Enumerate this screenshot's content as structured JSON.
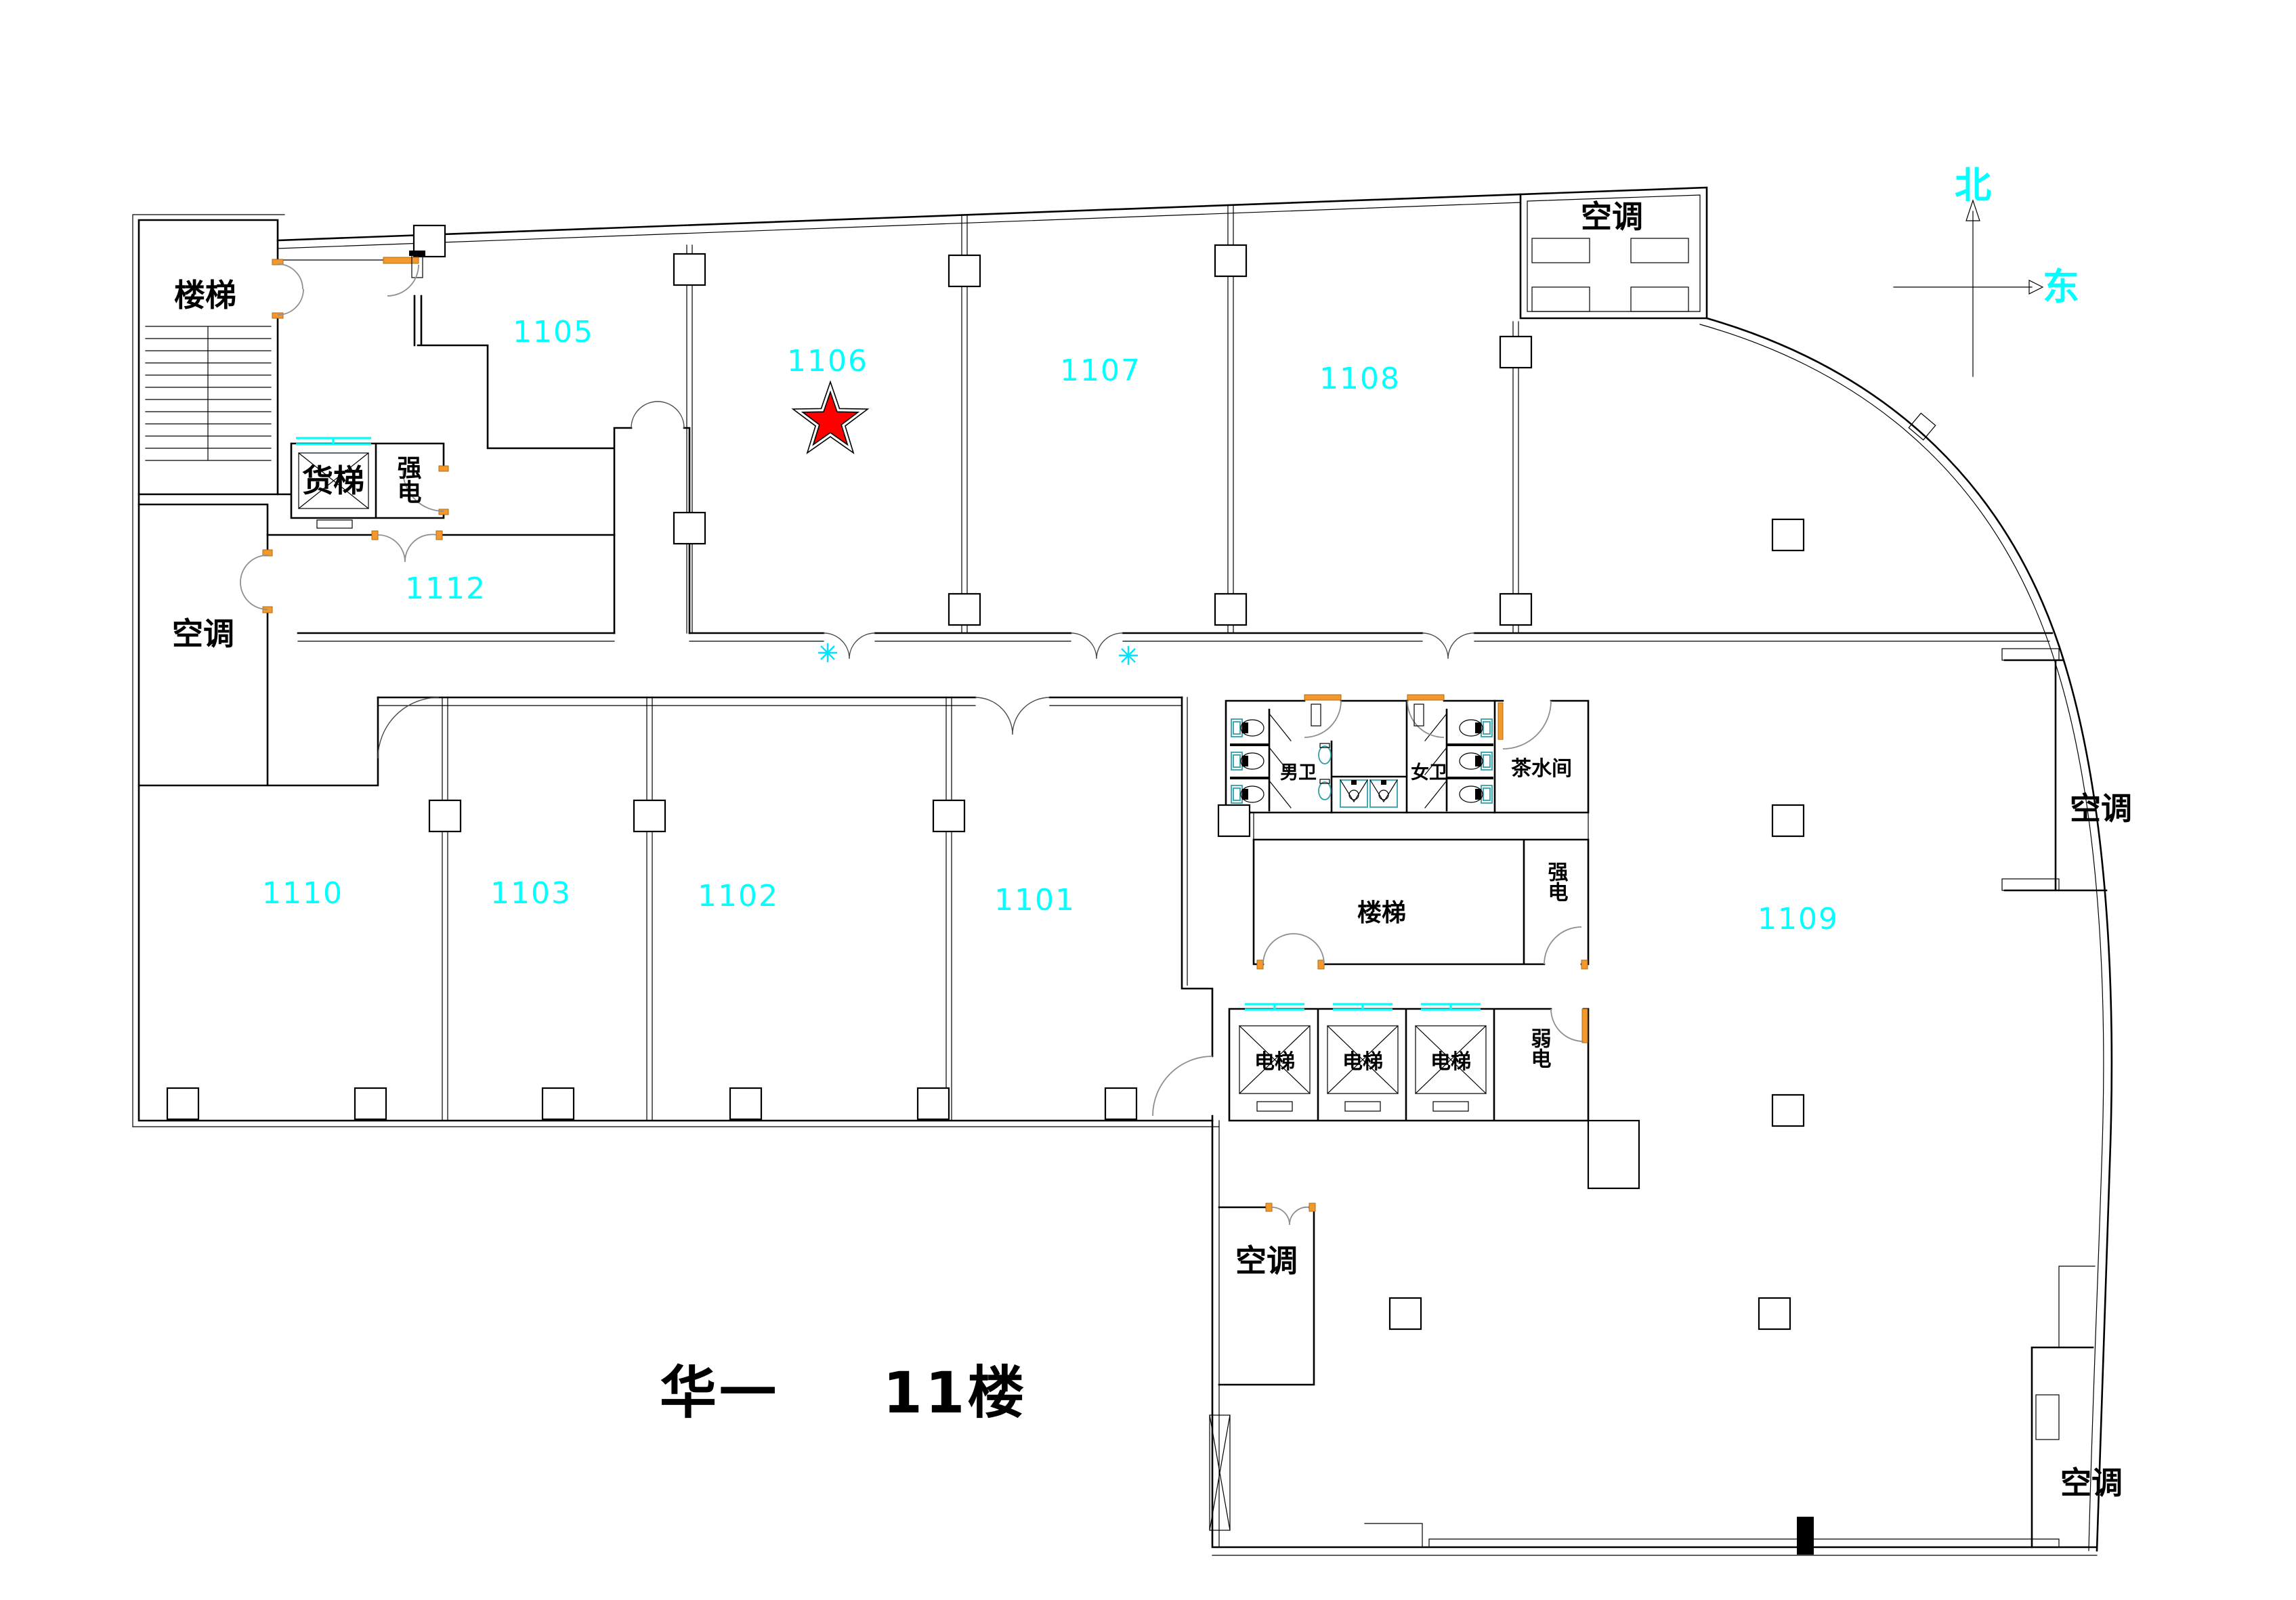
{
  "title": {
    "building": "华一",
    "floor": "11楼"
  },
  "compass": {
    "north": "北",
    "east": "东"
  },
  "room_numbers": {
    "r1101": "1101",
    "r1102": "1102",
    "r1103": "1103",
    "r1105": "1105",
    "r1106": "1106",
    "r1107": "1107",
    "r1108": "1108",
    "r1109": "1109",
    "r1110": "1110",
    "r1112": "1112"
  },
  "labels": {
    "stairs_nw": "楼梯",
    "freight_elevator": "货梯",
    "power_strong_nw": "强电",
    "ac_left": "空调",
    "ac_top_right": "空调",
    "ac_mid_right": "空调",
    "ac_bottom_center": "空调",
    "ac_bottom_right": "空调",
    "mens_wc": "男卫",
    "womens_wc": "女卫",
    "tea_room": "茶水间",
    "stairs_center": "楼梯",
    "power_strong_center": "强电",
    "elevator_1": "电梯",
    "elevator_2": "电梯",
    "elevator_3": "电梯",
    "power_weak": "弱电"
  },
  "marker": {
    "starred_room": "1106"
  },
  "colors": {
    "room_number": "#00ffff",
    "wall": "#000000",
    "door_frame": "#f2992e",
    "door_swing": "#8f8f8f",
    "fixture": "#2fa0a8",
    "star": "#ff0000",
    "window": "#00ffff"
  }
}
